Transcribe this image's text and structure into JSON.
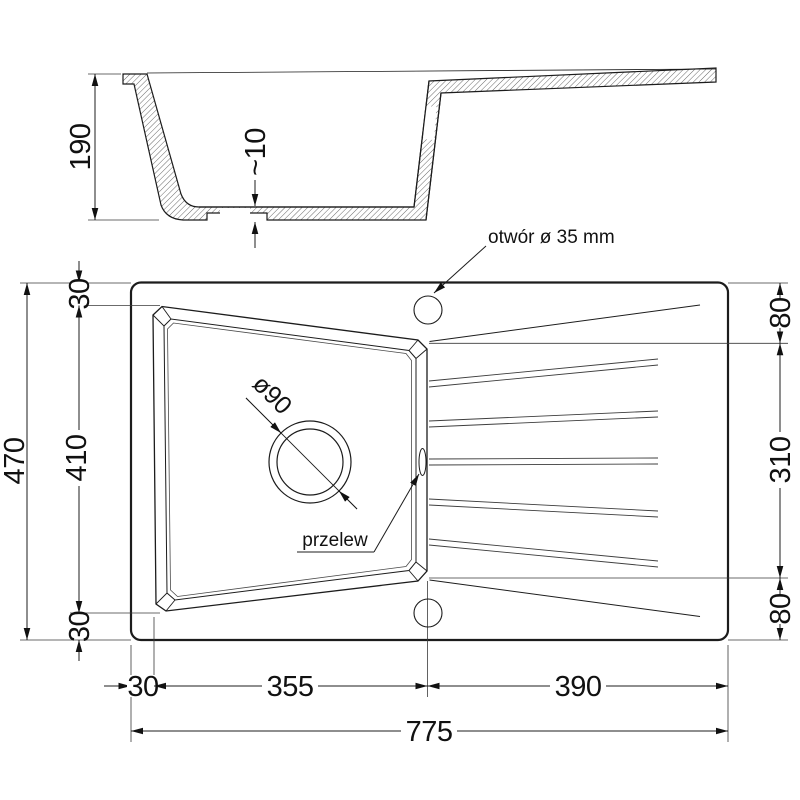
{
  "drawing": {
    "title_semantic": "kitchen sink technical drawing",
    "section": {
      "height": "190",
      "bottom_thickness": "~10"
    },
    "plan": {
      "hole_label": "otwór ø 35 mm",
      "overflow_label": "przelew",
      "drain_diameter": "ø90",
      "left": {
        "total": "470",
        "top": "30",
        "middle": "410",
        "bottom": "30"
      },
      "right": {
        "top": "80",
        "middle": "310",
        "bottom": "80"
      },
      "bottom": {
        "edge": "30",
        "bowl": "355",
        "drainer": "390",
        "total": "775"
      }
    },
    "colors": {
      "line": "#1c1c1c",
      "thin_line": "#3a3a3a",
      "background": "#ffffff"
    }
  }
}
